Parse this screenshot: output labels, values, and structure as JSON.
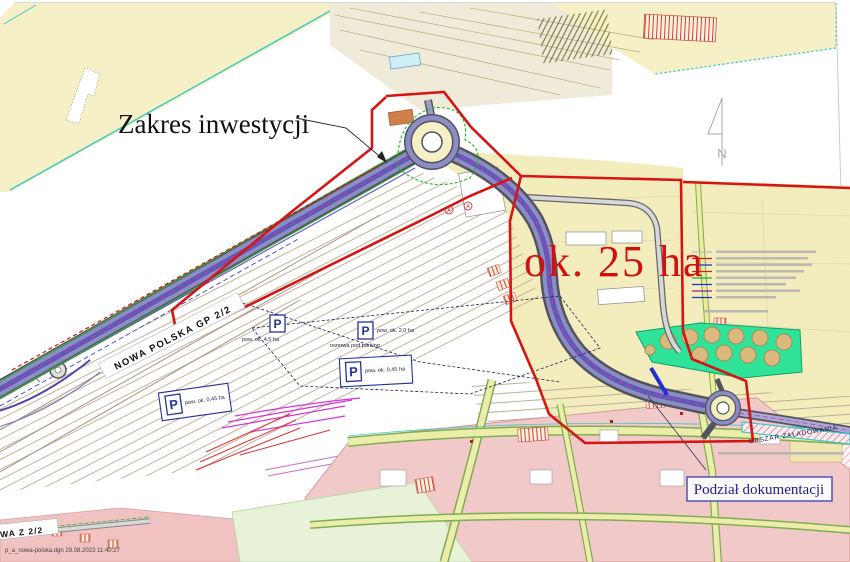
{
  "labels": {
    "investment_scope": "Zakres inwestycji",
    "area": "ok. 25 ha",
    "documentation": "Podział dokumentacji",
    "road_main": "NOWA POLSKA GP 2/2",
    "road_bottom": "NOWA Z 2/2",
    "loading_area": "OBSZAR ZAŁADOWANIA",
    "file_stamp": "p_a_nowa-polska.dgn 29.08.2023 11:40:27",
    "north": "N",
    "symbol_a": "A"
  },
  "parking": {
    "symbol": "P",
    "p1_area": "pow. ok. 4,5 ha",
    "p2_area": "pow. ok. 2,0 ha",
    "p2_note": "rezerwa pod parking",
    "p3_area": "pow. ok. 0,45 ha",
    "p4_area": "pow. ok. 0,45 ha"
  },
  "colors": {
    "boundary_red": "#d61414",
    "area_text_red": "#d21010",
    "doc_navy": "#1b1b8e",
    "map_yellow": "#f5f0c5",
    "road_purple": "#8d8dc6",
    "tank_green": "#2fe39b",
    "urban_pink": "#f2c9c9",
    "teal_edge": "#3fc8c8"
  }
}
